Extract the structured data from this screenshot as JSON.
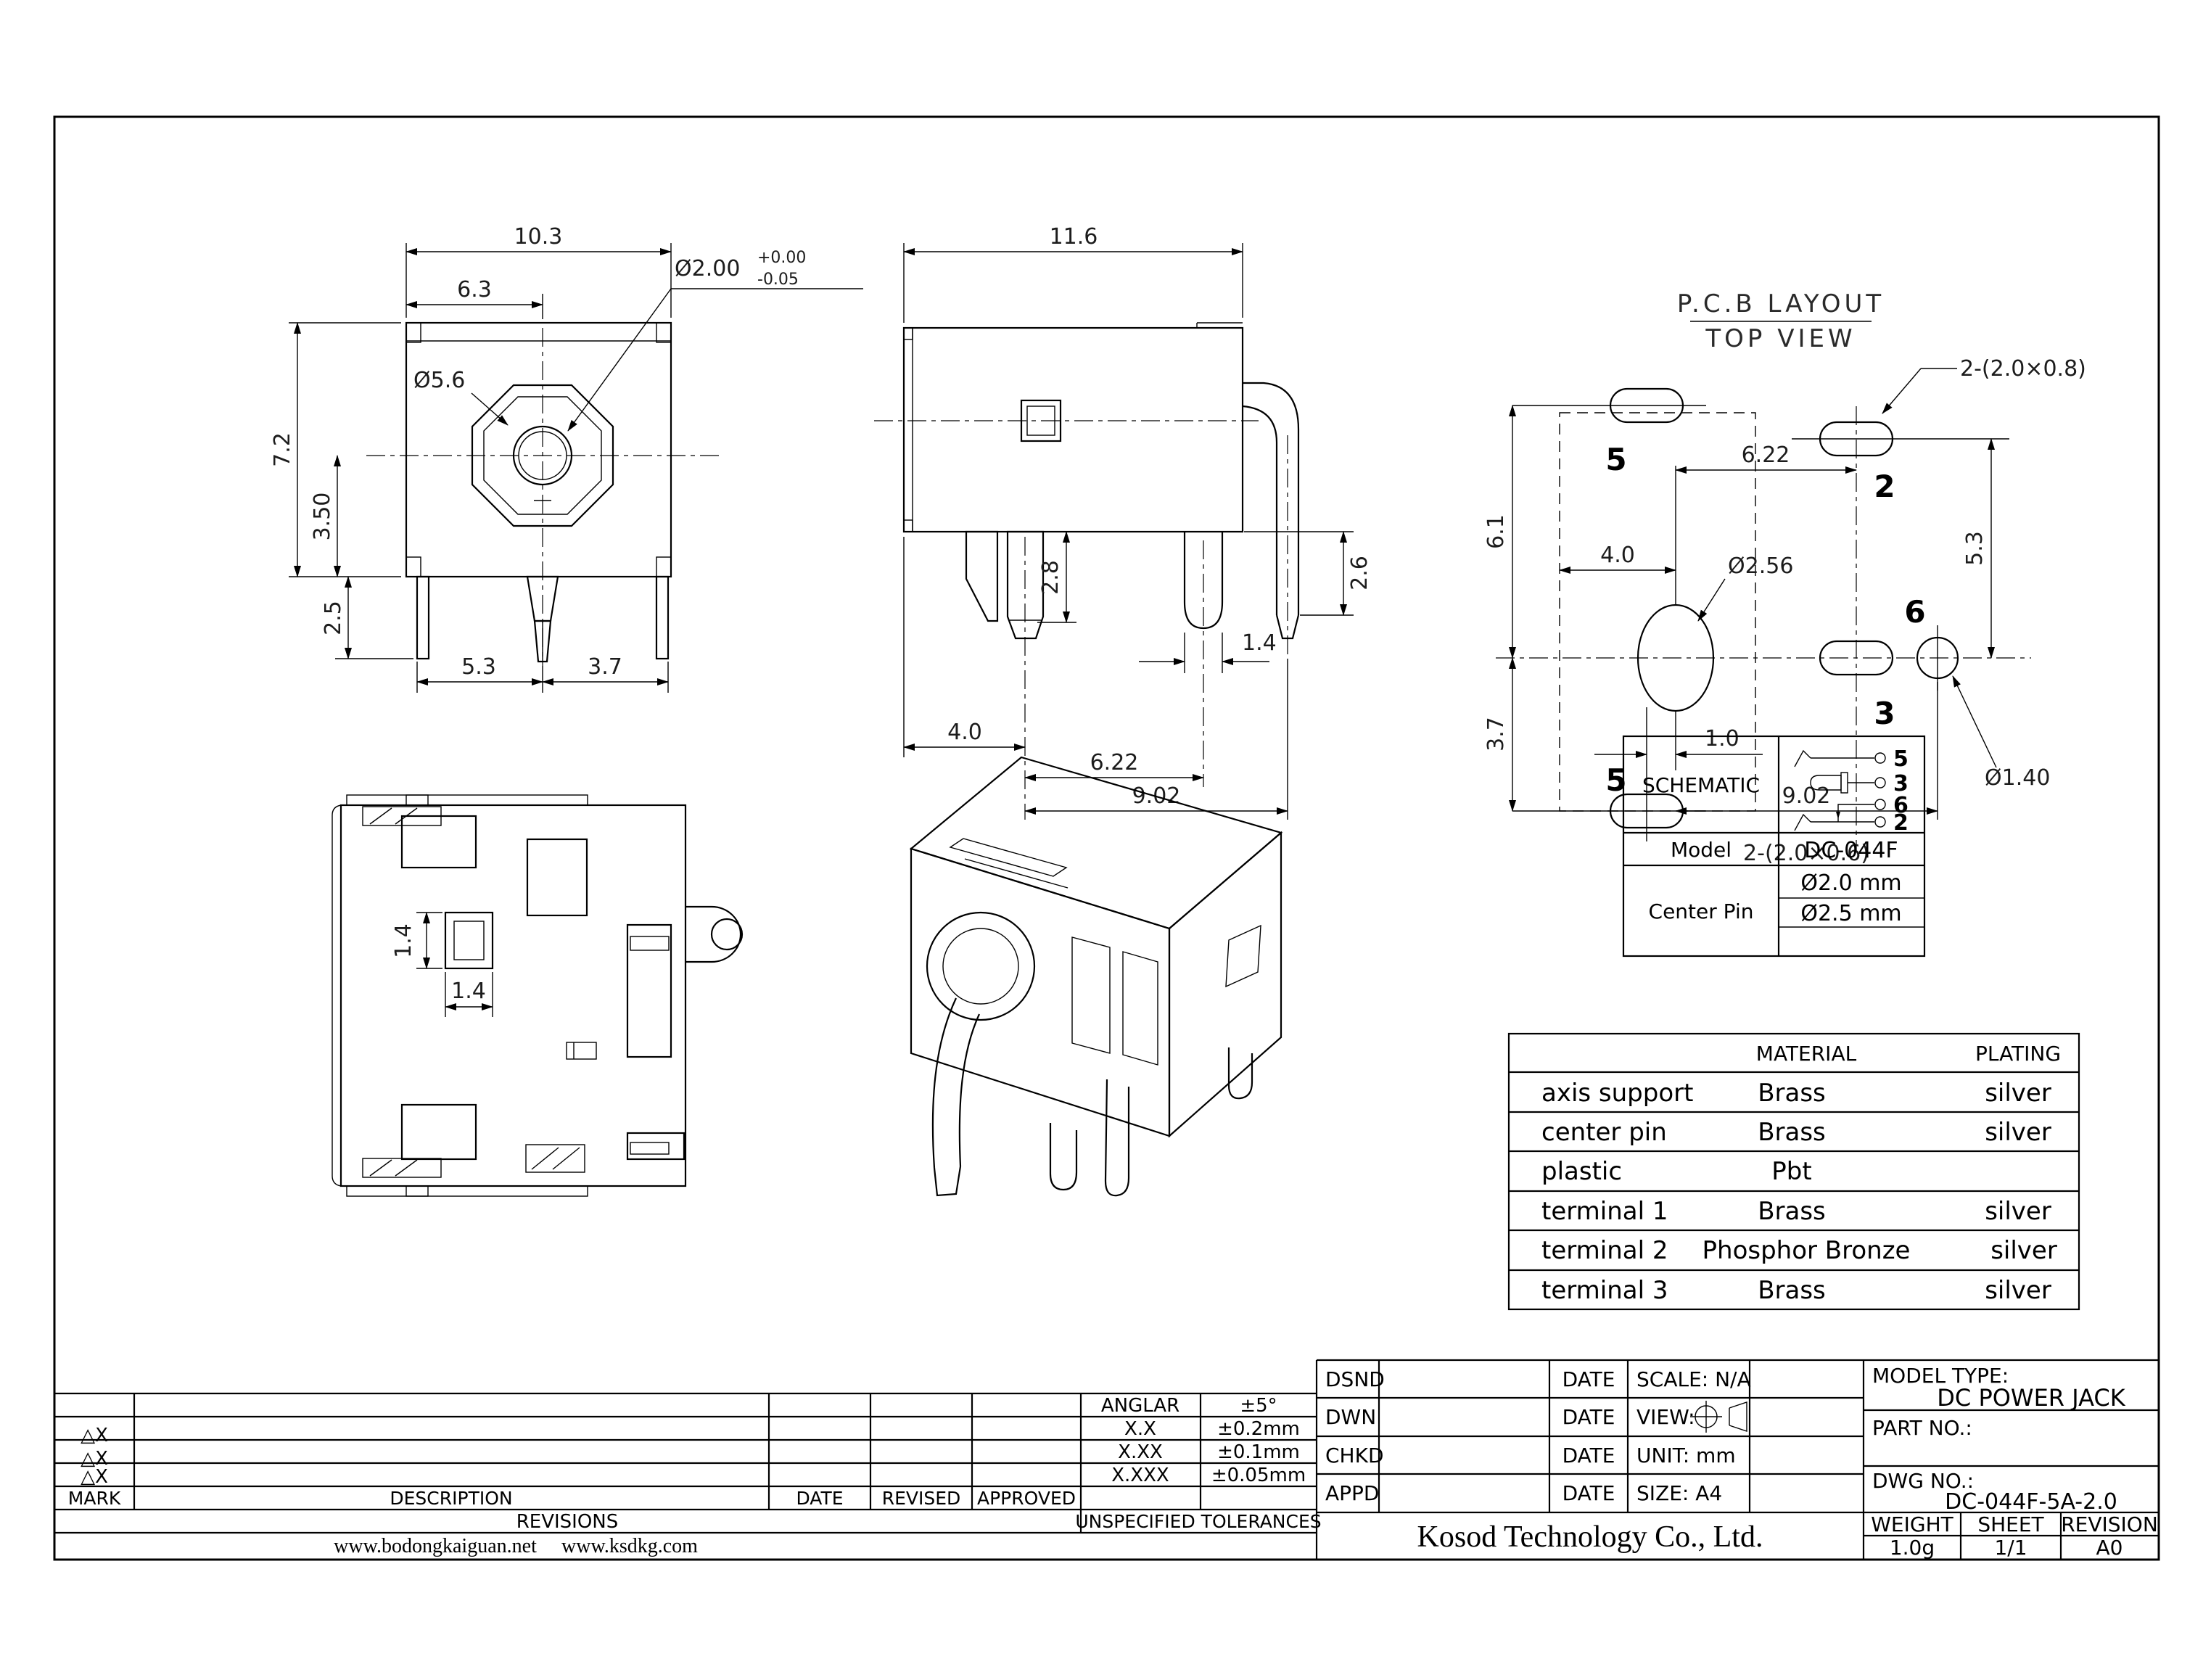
{
  "front_view": {
    "dim_width": "10.3",
    "dim_inner_width": "6.3",
    "pin_dia": "Ø2.00",
    "pin_tol_plus": "+0.00",
    "pin_tol_minus": "-0.05",
    "barrel_dia": "Ø5.6",
    "dim_height": "7.2",
    "dim_center_height": "3.50",
    "dim_leg_len": "2.5",
    "dim_bottom_left": "5.3",
    "dim_bottom_right": "3.7"
  },
  "side_view": {
    "dim_width": "11.6",
    "dim_front_pin": "2.8",
    "dim_right_pin": "2.6",
    "dim_mid_pin_width": "1.4",
    "dim_front_offset": "4.0",
    "dim_mid_offset": "6.22",
    "dim_total_offset": "9.02"
  },
  "pcb_view": {
    "title_line1": "P.C.B LAYOUT",
    "title_line2": "TOP VIEW",
    "note_top_pads": "2-(2.0×0.8)",
    "note_bottom_pads": "2-(2.0×0.6)",
    "dim_upper": "6.1",
    "dim_lower": "3.7",
    "dim_hole_offset": "4.0",
    "dim_pad_offset": "6.22",
    "dim_pad_vertical": "5.3",
    "dim_pin_offset": "1.0",
    "dim_total": "9.02",
    "hole_dia": "Ø2.56",
    "pin6_hole_dia": "Ø1.40",
    "pad_top_left": "5",
    "pad_bottom_left": "5",
    "pad_top_right": "2",
    "pad_middle": "3",
    "pad_right": "6"
  },
  "bottom_view": {
    "dim_square_h": "1.4",
    "dim_square_w": "1.4"
  },
  "schematic_table": {
    "title": "SCHEMATIC",
    "pin_top": "5",
    "pin_mid": "3",
    "pin_lower": "6",
    "pin_bottom": "2",
    "model_label": "Model",
    "model_value": "DC-044F",
    "center_pin_label": "Center Pin",
    "center_pin_values": [
      "Ø2.0 mm",
      "Ø2.5 mm"
    ]
  },
  "material_table": {
    "header_material": "MATERIAL",
    "header_plating": "PLATING",
    "rows": [
      {
        "part": "axis support",
        "material": "Brass",
        "plating": "silver"
      },
      {
        "part": "center pin",
        "material": "Brass",
        "plating": "silver"
      },
      {
        "part": "plastic",
        "material": "Pbt",
        "plating": ""
      },
      {
        "part": "terminal 1",
        "material": "Brass",
        "plating": "silver"
      },
      {
        "part": "terminal 2",
        "material": "Phosphor Bronze",
        "plating": "silver"
      },
      {
        "part": "terminal 3",
        "material": "Brass",
        "plating": "silver"
      }
    ]
  },
  "title_block": {
    "rows": [
      {
        "label": "DSND",
        "date": "DATE"
      },
      {
        "label": "DWN",
        "date": "DATE"
      },
      {
        "label": "CHKD",
        "date": "DATE"
      },
      {
        "label": "APPD",
        "date": "DATE"
      }
    ],
    "scale": "SCALE: N/A",
    "view_label": "VIEW:",
    "unit": "UNIT: mm",
    "size": "SIZE: A4",
    "model_type_label": "MODEL TYPE:",
    "model_type": "DC POWER JACK",
    "part_no_label": "PART NO.:",
    "dwg_no_label": "DWG NO.:",
    "dwg_no": "DC-044F-5A-2.0",
    "company": "Kosod Technology Co., Ltd.",
    "weight_label": "WEIGHT",
    "sheet_label": "SHEET",
    "revision_label": "REVISION",
    "weight": "1.0g",
    "sheet": "1/1",
    "revision": "A0"
  },
  "revision_table": {
    "marks": [
      "△X",
      "△X",
      "△X"
    ],
    "mark_label": "MARK",
    "description_label": "DESCRIPTION",
    "date_label": "DATE",
    "revised_label": "REVISED",
    "approved_label": "APPROVED",
    "revisions_label": "REVISIONS",
    "tolerances_label": "UNSPECIFIED TOLERANCES",
    "tolerances": [
      {
        "name": "ANGLAR",
        "value": "±5°"
      },
      {
        "name": "X.X",
        "value": "±0.2mm"
      },
      {
        "name": "X.XX",
        "value": "±0.1mm"
      },
      {
        "name": "X.XXX",
        "value": "±0.05mm"
      }
    ],
    "website_left": "www.bodongkaiguan.net",
    "website_right": "www.ksdkg.com"
  }
}
